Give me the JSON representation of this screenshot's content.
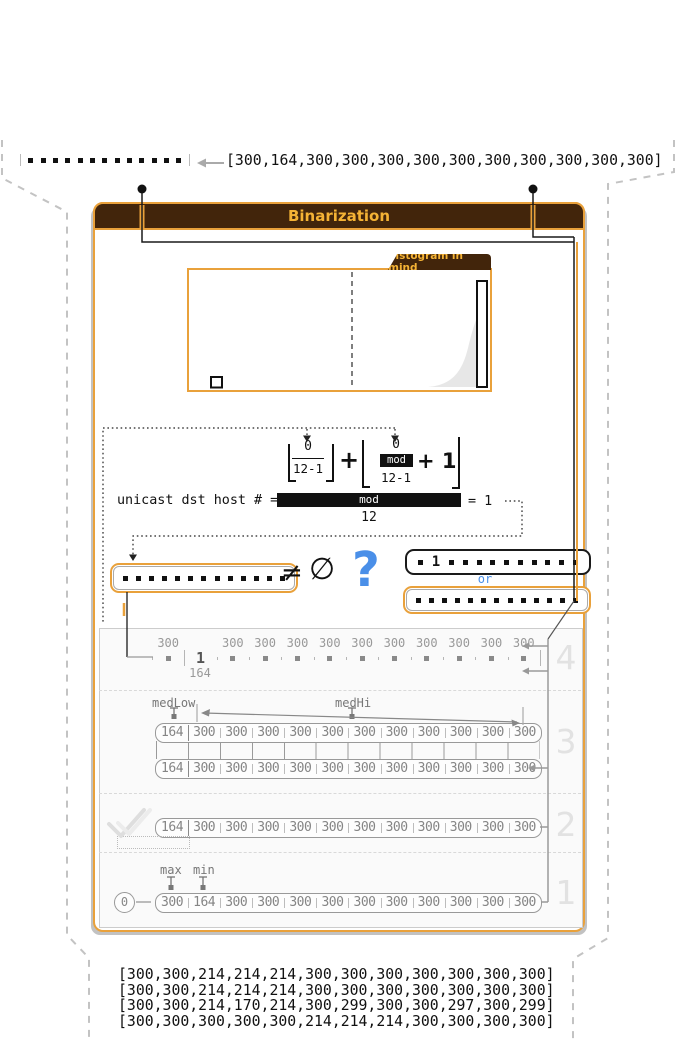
{
  "colors": {
    "accent_gold": "#E9A13B",
    "header_brown": "#42250B",
    "header_text": "#F5B335",
    "blue": "#4A8FE8",
    "gray": "#8A8A8A"
  },
  "input": {
    "array_text": "[300,164,300,300,300,300,300,300,300,300,300,300]",
    "dots_count": 13
  },
  "panel": {
    "title": "Binarization"
  },
  "histogram": {
    "tab_label": "histogram in mind"
  },
  "formula": {
    "term1_numerator": "0",
    "term1_denominator": "12-1",
    "plus": "+",
    "term2_numerator": "0",
    "term2_mod": "mod",
    "term2_denominator": "12-1",
    "term2_suffix": "+ 1"
  },
  "equation": {
    "label": "unicast dst host # =",
    "bar_label": "mod",
    "denominator": "12",
    "result": "= 1"
  },
  "comparison": {
    "neq": "≠",
    "empty": "∅",
    "question": "?",
    "or": "or",
    "one": "1",
    "left_dots": 13,
    "pre_dots": 1,
    "post_dots": 10,
    "bottom_dots": 13
  },
  "steps": {
    "step4": {
      "num": "4",
      "labels_top": [
        "300",
        "",
        "300",
        "300",
        "300",
        "300",
        "300",
        "300",
        "300",
        "300",
        "300",
        "300"
      ],
      "cells": [
        "dot",
        "1",
        "dot",
        "dot",
        "dot",
        "dot",
        "dot",
        "dot",
        "dot",
        "dot",
        "dot",
        "dot"
      ],
      "below_label": "164"
    },
    "step3": {
      "num": "3",
      "med_low": "medLow",
      "med_hi": "medHi",
      "row1": [
        "164",
        "300",
        "300",
        "300",
        "300",
        "300",
        "300",
        "300",
        "300",
        "300",
        "300",
        "300"
      ],
      "row2": [
        "164",
        "300",
        "300",
        "300",
        "300",
        "300",
        "300",
        "300",
        "300",
        "300",
        "300",
        "300"
      ]
    },
    "step2": {
      "num": "2",
      "row": [
        "164",
        "300",
        "300",
        "300",
        "300",
        "300",
        "300",
        "300",
        "300",
        "300",
        "300",
        "300"
      ]
    },
    "step1": {
      "num": "1",
      "start": "0",
      "max_label": "max",
      "min_label": "min",
      "row": [
        "300",
        "164",
        "300",
        "300",
        "300",
        "300",
        "300",
        "300",
        "300",
        "300",
        "300",
        "300"
      ]
    }
  },
  "output_arrays": [
    "[300,300,214,214,214,300,300,300,300,300,300,300]",
    "[300,300,214,214,214,300,300,300,300,300,300,300]",
    "[300,300,214,170,214,300,299,300,300,297,300,299]",
    "[300,300,300,300,300,214,214,214,300,300,300,300]"
  ]
}
